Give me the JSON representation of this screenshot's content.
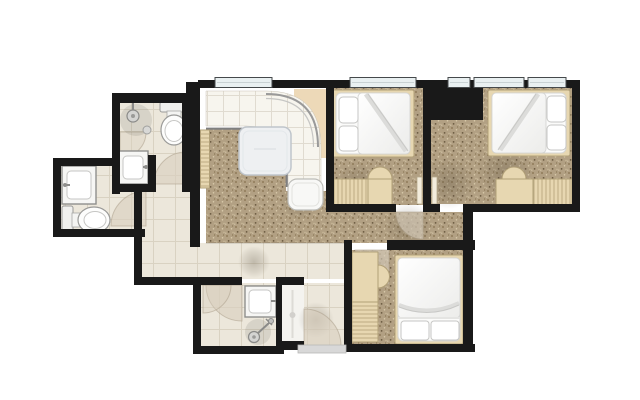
{
  "plan": {
    "type": "apartment-floor-plan",
    "colors": {
      "bg": "#ffffff",
      "wall": "#191919",
      "carpet": "#b2a083",
      "dot1": "#85714e",
      "dot2": "#d9cbab",
      "dot3": "#6a5940",
      "dot4": "#cdbd9d",
      "tile": "#ece7db",
      "tile_grout": "#d9d2c2",
      "counter": "#f7f5ee",
      "counter_grout": "#e0dbd0",
      "wood": "#e7d7b1",
      "wood_line": "#b1a078",
      "tan": "#edd9b8",
      "door": "#d9cfbe",
      "window": "#e9f0f1",
      "table": "#eef0f2",
      "closet": "#f4f3ef",
      "threshold": "#d8d8d8"
    },
    "rooms": [
      {
        "name": "bathroom-top-left",
        "floor": "tile",
        "fixtures": [
          "shower-icon",
          "shower-door-arc",
          "toilet-icon",
          "sink-icon",
          "door-arc"
        ]
      },
      {
        "name": "bathroom-left",
        "floor": "tile",
        "fixtures": [
          "sink-icon",
          "toilet-icon",
          "door-arc"
        ]
      },
      {
        "name": "kitchen-dining",
        "floor": "carpet",
        "fixtures": [
          "curved-counter",
          "counter-end-cabinet",
          "square-table",
          "door-leaf"
        ]
      },
      {
        "name": "bedroom-top-middle",
        "floor": "carpet",
        "fixtures": [
          "double-bed",
          "pillows",
          "dresser",
          "desk",
          "chair",
          "door-leaves"
        ]
      },
      {
        "name": "bedroom-top-right",
        "floor": "carpet",
        "fixtures": [
          "double-bed",
          "pillows",
          "desk",
          "chair",
          "dresser"
        ]
      },
      {
        "name": "bedroom-bottom",
        "floor": "carpet",
        "fixtures": [
          "double-bed",
          "pillows",
          "desk",
          "chair",
          "drawer-unit",
          "door-arc"
        ]
      },
      {
        "name": "bathroom-bottom",
        "floor": "tile",
        "fixtures": [
          "sink-icon",
          "shower-icon",
          "double-door-arc"
        ]
      },
      {
        "name": "closet",
        "floor": "plain",
        "fixtures": [
          "rod"
        ]
      },
      {
        "name": "entry",
        "floor": "tile",
        "fixtures": [
          "entry-door-arc",
          "threshold"
        ]
      },
      {
        "name": "hallway",
        "floor": "carpet",
        "fixtures": []
      },
      {
        "name": "corridor",
        "floor": "tile",
        "fixtures": []
      },
      {
        "name": "utility-shaft",
        "floor": "solid",
        "fixtures": []
      }
    ],
    "counts": {
      "bedrooms": 3,
      "bathrooms": 3,
      "beds": 3,
      "toilets": 2,
      "sinks": 3,
      "showers": 2,
      "windows": 5,
      "door_arcs": 8
    }
  }
}
